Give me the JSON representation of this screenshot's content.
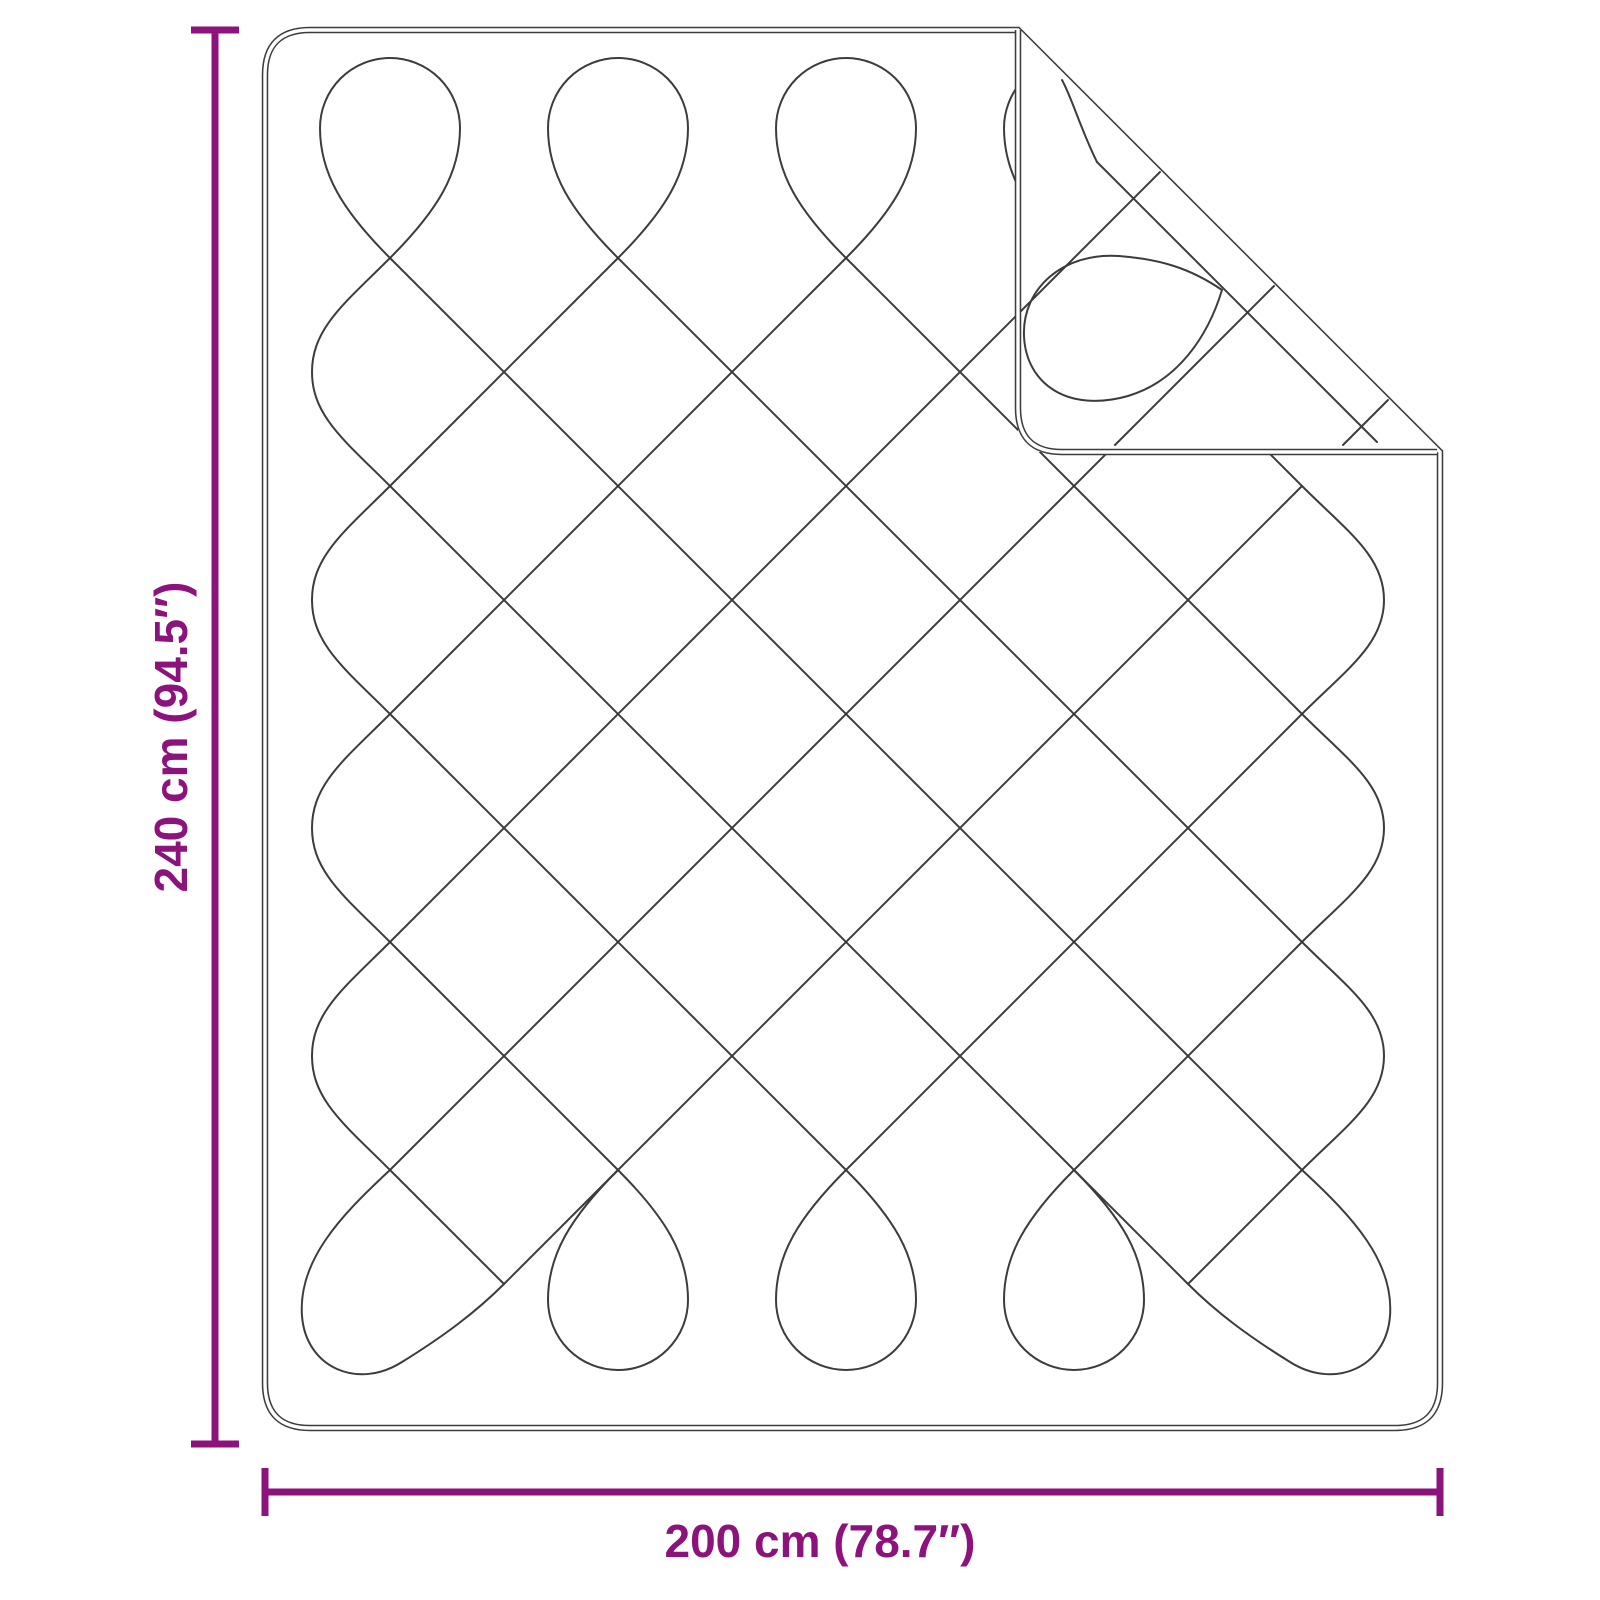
{
  "diagram": {
    "title_semantic": "quilted-blanket-dimension-diagram",
    "height_label": "240 cm (94.5″)",
    "width_label": "200 cm (78.7″)"
  },
  "colors": {
    "dimension_accent": "#8C127C",
    "outline": "#3C3C3C",
    "background": "#FFFFFF"
  }
}
